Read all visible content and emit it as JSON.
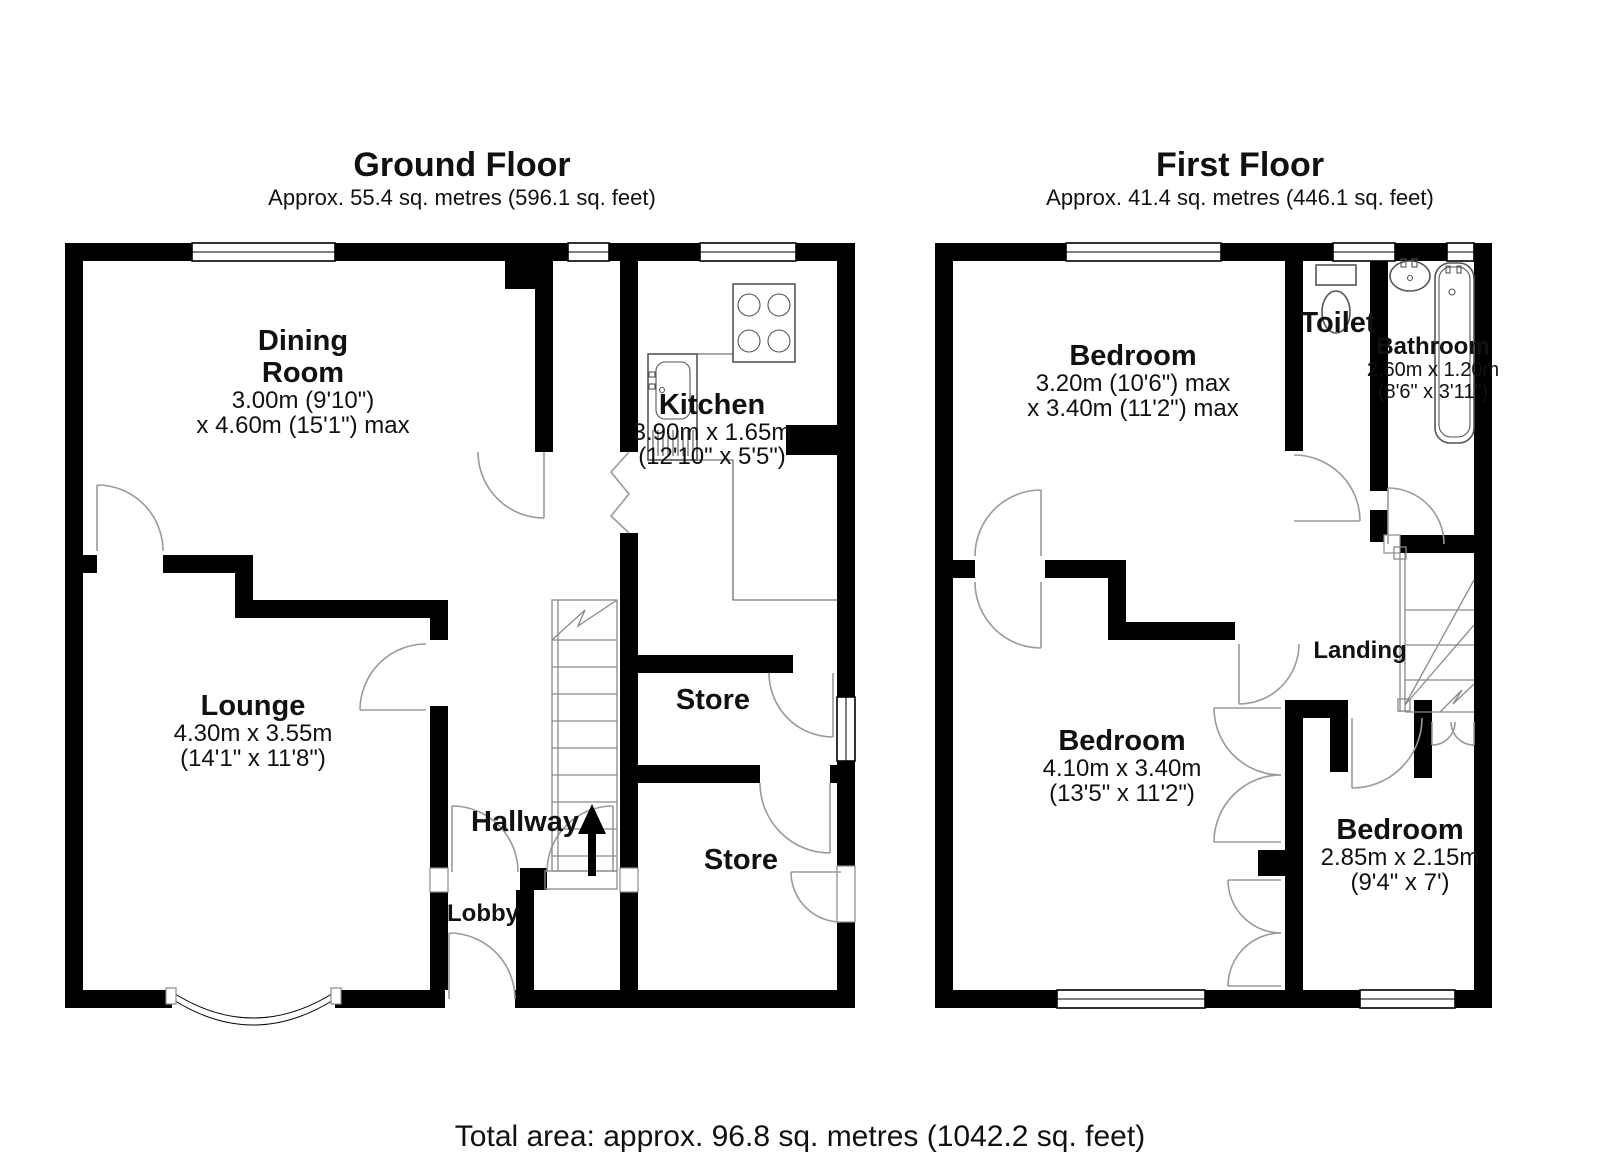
{
  "ground_floor": {
    "title": "Ground Floor",
    "subtitle": "Approx. 55.4 sq. metres (596.1 sq. feet)",
    "rooms": {
      "dining": {
        "line1": "Dining",
        "line2": "Room",
        "dims1": "3.00m (9'10\")",
        "dims2": "x 4.60m (15'1\") max"
      },
      "kitchen": {
        "name": "Kitchen",
        "dims1": "3.90m x 1.65m",
        "dims2": "(12'10\" x 5'5\")"
      },
      "lounge": {
        "name": "Lounge",
        "dims1": "4.30m x 3.55m",
        "dims2": "(14'1\" x 11'8\")"
      },
      "hallway": {
        "name": "Hallway"
      },
      "lobby": {
        "name": "Lobby"
      },
      "store_upper": {
        "name": "Store"
      },
      "store_lower": {
        "name": "Store"
      }
    }
  },
  "first_floor": {
    "title": "First Floor",
    "subtitle": "Approx. 41.4 sq. metres (446.1 sq. feet)",
    "rooms": {
      "bedroom1": {
        "name": "Bedroom",
        "dims1": "3.20m (10'6\") max",
        "dims2": "x 3.40m (11'2\") max"
      },
      "toilet": {
        "name": "Toilet"
      },
      "bathroom": {
        "name": "Bathroom",
        "dims1": "2.60m x 1.20m",
        "dims2": "(8'6\" x 3'11\")"
      },
      "landing": {
        "name": "Landing"
      },
      "bedroom2": {
        "name": "Bedroom",
        "dims1": "4.10m x 3.40m",
        "dims2": "(13'5\" x 11'2\")"
      },
      "bedroom3": {
        "name": "Bedroom",
        "dims1": "2.85m x 2.15m",
        "dims2": "(9'4\" x 7')"
      }
    }
  },
  "footer": {
    "total_area": "Total area: approx. 96.8 sq. metres (1042.2 sq. feet)"
  },
  "colors": {
    "wall": "#000000",
    "background": "#ffffff",
    "door_line": "#9a9a9a"
  }
}
